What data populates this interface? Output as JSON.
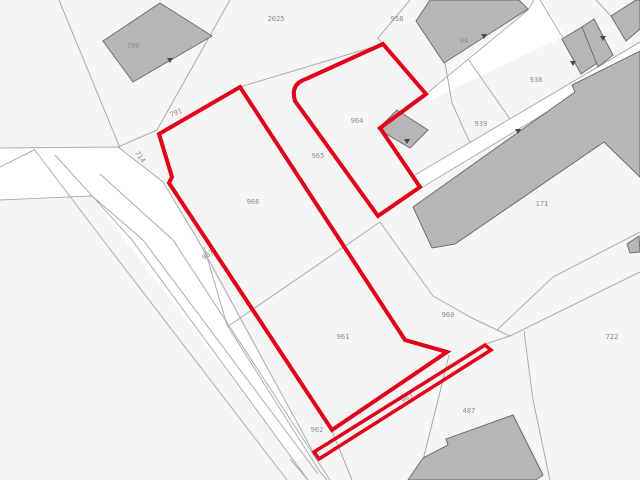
{
  "map": {
    "title": "cadastral parcel map",
    "colors": {
      "background": "#f5f5f4",
      "road": "#ffffff",
      "boundary_line": "#adadad",
      "building_fill": "#b7b6b5",
      "building_stroke": "#6f6e6d",
      "highlight_red": "#e2001a",
      "label": "#8c8c8c",
      "arrow": "#4a4a4a"
    },
    "labels": [
      {
        "text": "790",
        "x": 133,
        "y": 46,
        "rot": 0
      },
      {
        "text": "2025",
        "x": 276,
        "y": 19,
        "rot": 0
      },
      {
        "text": "958",
        "x": 397,
        "y": 19,
        "rot": 0
      },
      {
        "text": "94",
        "x": 464,
        "y": 41,
        "rot": 0
      },
      {
        "text": "938",
        "x": 536,
        "y": 80,
        "rot": 0
      },
      {
        "text": "939",
        "x": 481,
        "y": 124,
        "rot": 0
      },
      {
        "text": "964",
        "x": 357,
        "y": 121,
        "rot": 0
      },
      {
        "text": "965",
        "x": 318,
        "y": 156,
        "rot": 0
      },
      {
        "text": "966",
        "x": 253,
        "y": 202,
        "rot": 0
      },
      {
        "text": "967",
        "x": 208,
        "y": 255,
        "rot": -35
      },
      {
        "text": "961",
        "x": 343,
        "y": 337,
        "rot": 0
      },
      {
        "text": "960",
        "x": 448,
        "y": 315,
        "rot": 0
      },
      {
        "text": "962",
        "x": 317,
        "y": 430,
        "rot": 0
      },
      {
        "text": "963",
        "x": 407,
        "y": 398,
        "rot": -32
      },
      {
        "text": "487",
        "x": 469,
        "y": 411,
        "rot": 0
      },
      {
        "text": "722",
        "x": 612,
        "y": 337,
        "rot": 0
      },
      {
        "text": "171",
        "x": 542,
        "y": 204,
        "rot": 0
      },
      {
        "text": "791",
        "x": 176,
        "y": 113,
        "rot": -22
      },
      {
        "text": "714",
        "x": 140,
        "y": 157,
        "rot": 55
      }
    ],
    "roads": [
      [
        [
          0,
          148
        ],
        [
          118,
          147
        ],
        [
          163,
          182
        ],
        [
          313,
          452
        ],
        [
          295,
          462
        ],
        [
          92,
          197
        ],
        [
          0,
          201
        ]
      ],
      [
        [
          415,
          175
        ],
        [
          640,
          42
        ],
        [
          640,
          56
        ],
        [
          421,
          188
        ]
      ],
      [
        [
          426,
          94
        ],
        [
          534,
          0
        ],
        [
          541,
          0
        ],
        [
          565,
          36
        ],
        [
          430,
          100
        ]
      ]
    ],
    "boundary_lines": [
      [
        [
          59,
          0
        ],
        [
          120,
          148
        ]
      ],
      [
        [
          230,
          0
        ],
        [
          157,
          130
        ]
      ],
      [
        [
          157,
          130
        ],
        [
          118,
          147
        ]
      ],
      [
        [
          0,
          148
        ],
        [
          118,
          147
        ],
        [
          163,
          182
        ],
        [
          198,
          240
        ],
        [
          313,
          452
        ]
      ],
      [
        [
          34,
          149
        ],
        [
          103,
          240
        ],
        [
          287,
          480
        ]
      ],
      [
        [
          0,
          167
        ],
        [
          34,
          150
        ]
      ],
      [
        [
          55,
          155
        ],
        [
          132,
          240
        ],
        [
          308,
          480
        ]
      ],
      [
        [
          0,
          200
        ],
        [
          92,
          196
        ],
        [
          143,
          240
        ],
        [
          318,
          474
        ]
      ],
      [
        [
          100,
          174
        ],
        [
          173,
          240
        ],
        [
          330,
          480
        ]
      ],
      [
        [
          204,
          247
        ],
        [
          227,
          325
        ],
        [
          320,
          472
        ],
        [
          327,
          480
        ]
      ],
      [
        [
          290,
          459
        ],
        [
          308,
          480
        ]
      ],
      [
        [
          332,
          431
        ],
        [
          352,
          480
        ]
      ],
      [
        [
          240,
          87
        ],
        [
          383,
          44
        ]
      ],
      [
        [
          410,
          0
        ],
        [
          378,
          38
        ],
        [
          383,
          44
        ]
      ],
      [
        [
          426,
          94
        ],
        [
          528,
          10
        ],
        [
          534,
          0
        ]
      ],
      [
        [
          445,
          63
        ],
        [
          452,
          103
        ],
        [
          470,
          143
        ]
      ],
      [
        [
          468,
          59
        ],
        [
          510,
          119
        ]
      ],
      [
        [
          415,
          175
        ],
        [
          640,
          42
        ]
      ],
      [
        [
          421,
          188
        ],
        [
          640,
          56
        ]
      ],
      [
        [
          540,
          0
        ],
        [
          563,
          38
        ]
      ],
      [
        [
          596,
          0
        ],
        [
          611,
          16
        ]
      ],
      [
        [
          227,
          327
        ],
        [
          380,
          222
        ]
      ],
      [
        [
          380,
          222
        ],
        [
          433,
          296
        ],
        [
          472,
          318
        ],
        [
          497,
          330
        ]
      ],
      [
        [
          497,
          330
        ],
        [
          510,
          336
        ],
        [
          486,
          344
        ]
      ],
      [
        [
          497,
          330
        ],
        [
          553,
          277
        ],
        [
          640,
          232
        ]
      ],
      [
        [
          510,
          336
        ],
        [
          640,
          272
        ]
      ],
      [
        [
          524,
          331
        ],
        [
          533,
          400
        ],
        [
          550,
          480
        ]
      ],
      [
        [
          449,
          355
        ],
        [
          438,
          400
        ],
        [
          418,
          480
        ]
      ]
    ],
    "buildings": [
      {
        "name": "building-790",
        "points": [
          [
            160,
            3
          ],
          [
            212,
            36
          ],
          [
            133,
            82
          ],
          [
            103,
            41
          ]
        ]
      },
      {
        "name": "building-94",
        "points": [
          [
            416,
            21
          ],
          [
            430,
            0
          ],
          [
            519,
            0
          ],
          [
            528,
            9
          ],
          [
            444,
            63
          ]
        ]
      },
      {
        "name": "building-964",
        "points": [
          [
            397,
            110
          ],
          [
            428,
            130
          ],
          [
            410,
            148
          ],
          [
            378,
            129
          ]
        ]
      },
      {
        "name": "building-171",
        "points": [
          [
            413,
            207
          ],
          [
            575,
            92
          ],
          [
            572,
            85
          ],
          [
            640,
            51
          ],
          [
            640,
            177
          ],
          [
            604,
            142
          ],
          [
            455,
            244
          ],
          [
            432,
            248
          ]
        ]
      },
      {
        "name": "building-top-right-a",
        "points": [
          [
            562,
            39
          ],
          [
            582,
            27
          ],
          [
            600,
            61
          ],
          [
            581,
            74
          ]
        ]
      },
      {
        "name": "building-top-right-b",
        "points": [
          [
            582,
            27
          ],
          [
            594,
            19
          ],
          [
            613,
            55
          ],
          [
            598,
            67
          ]
        ]
      },
      {
        "name": "building-corner",
        "points": [
          [
            611,
            16
          ],
          [
            636,
            0
          ],
          [
            640,
            0
          ],
          [
            640,
            29
          ],
          [
            626,
            41
          ]
        ]
      },
      {
        "name": "building-487",
        "points": [
          [
            513,
            415
          ],
          [
            543,
            475
          ],
          [
            536,
            480
          ],
          [
            408,
            480
          ],
          [
            423,
            458
          ],
          [
            448,
            445
          ],
          [
            446,
            439
          ]
        ]
      },
      {
        "name": "building-edge-722",
        "points": [
          [
            627,
            244
          ],
          [
            639,
            236
          ],
          [
            640,
            252
          ],
          [
            630,
            253
          ]
        ]
      }
    ],
    "arrows": [
      {
        "x": 170,
        "y": 60
      },
      {
        "x": 484,
        "y": 36
      },
      {
        "x": 518,
        "y": 131
      },
      {
        "x": 573,
        "y": 63
      },
      {
        "x": 603,
        "y": 38
      },
      {
        "x": 407,
        "y": 141
      }
    ],
    "red_parcels": [
      {
        "name": "selected-parcel-outline-966-961",
        "path": "M 240,87 L 405,340 L 447,352 L 332,430 L 169,183 L 172,177 L 159,134 Z",
        "width": 4
      },
      {
        "name": "selected-parcel-outline-964",
        "path": "M 383,44 L 426,94 L 380,128 L 420,187 L 378,216 L 295,101 Q 290,84 306,79 Z",
        "width": 4
      },
      {
        "name": "selected-parcel-outline-963",
        "path": "M 314,452 L 485,345 L 491,350 L 319,459 Z",
        "width": 3.5
      }
    ],
    "label_font_size": 7
  }
}
